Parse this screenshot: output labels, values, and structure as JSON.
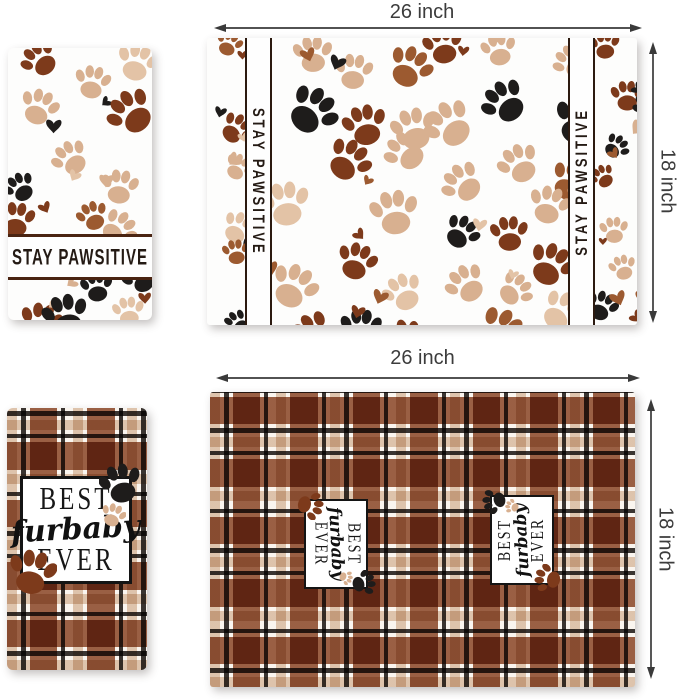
{
  "dimensions": {
    "placemat_top": {
      "width_label": "26 inch",
      "height_label": "18 inch"
    },
    "placemat_bottom": {
      "width_label": "26 inch",
      "height_label": "18 inch"
    }
  },
  "towel_top": {
    "slogan": "STAY PAWSITIVE"
  },
  "placemat_top": {
    "left_slogan": "STAY PAWSITIVE",
    "right_slogan": "STAY PAWSITIVE"
  },
  "furbaby_label": {
    "word_top": "BEST",
    "word_middle": "furbaby",
    "word_bottom": "EVER"
  },
  "palette": {
    "dark_brown": "#7d3a1b",
    "mid_brown": "#9c5a30",
    "tan": "#d8b090",
    "light_tan": "#e3c3a6",
    "paw_black": "#1e1c1b",
    "line_brown": "#4a2412",
    "plaid_brown": "#8c4828",
    "plaid_tan": "#d8baa0",
    "plaid_black": "#262220",
    "arrow_color": "#3a3a3a"
  }
}
